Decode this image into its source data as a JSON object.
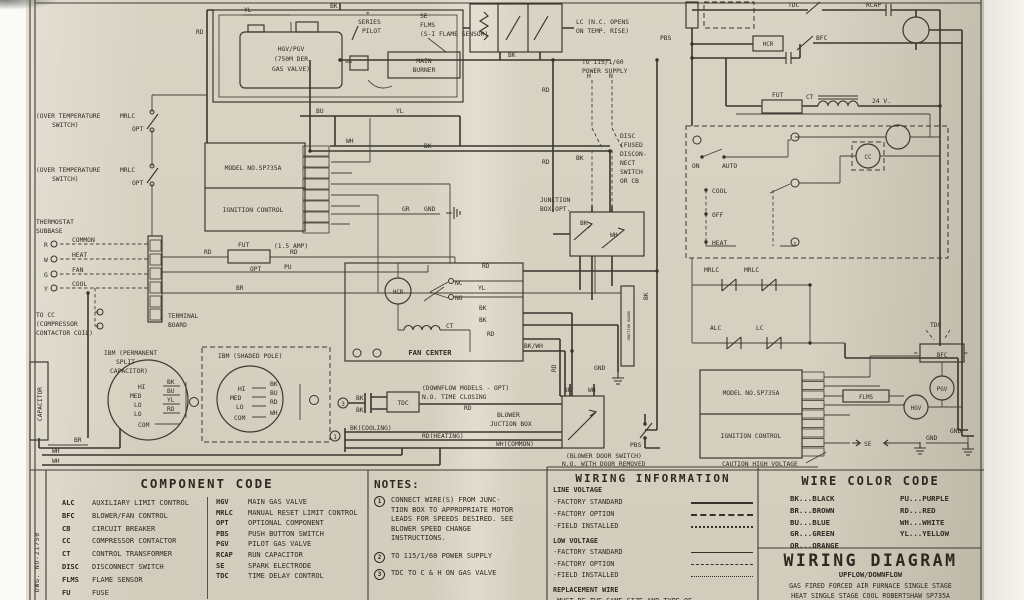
{
  "sch": {
    "top_yl": "YL",
    "top_bk": "BK",
    "left_rd": "RD",
    "valve1": "HGV/PGV",
    "valve2": "(750M DER",
    "valve3": "GAS VALVE)",
    "series1": "SERIES",
    "series2": "PILOT",
    "star": "*",
    "se1": "SE",
    "flms1": "FLMS",
    "fsensor": "(S-I FLAME SENSOR)",
    "burner1": "MAIN",
    "burner2": "BURNER",
    "bu": "BU",
    "yl2": "YL",
    "wh2": "WH",
    "bk2": "BK",
    "bk3": "BK",
    "lc1": "LC (N.C. OPENS",
    "lc2": "ON TEMP. RISE)",
    "ps1": "TO 115/1/60",
    "ps2": "POWER SUPPLY",
    "h": "H",
    "n": "N",
    "disc1": "DISC",
    "disc2": "(FUSED",
    "disc3": "DISCON-",
    "disc4": "NECT",
    "disc5": "SWITCH",
    "disc6": "OR CB",
    "bkv": "BK",
    "rd1": "RD",
    "rd2": "RD",
    "ot1": "(OVER TEMPERATURE",
    "ot2": "SWITCH)",
    "mrlc1": "MRLC",
    "opt1": "OPT",
    "ot3": "(OVER TEMPERATURE",
    "ot4": "SWITCH)",
    "mrlc2": "MRLC",
    "opt2": "OPT",
    "thermo1": "THERMOSTAT",
    "thermo2": "SUBBASE",
    "common": "COMMON",
    "heat1": "HEAT",
    "fan1": "FAN",
    "cool1": "COOL",
    "tr": "R",
    "tw": "W",
    "tg": "G",
    "ty": "Y",
    "tb1": "TERMINAL",
    "tb2": "BOARD",
    "tocc1": "TO CC",
    "tocc2": "(COMPRESSOR",
    "tocc3": "CONTACTOR COIL)",
    "cap": "CAPACITOR",
    "psc1": "IBM (PERMANENT",
    "psc2": "SPLIT",
    "psc3": "CAPACITOR)",
    "m1_hi": "HI",
    "m1_med": "MED",
    "m1_lo1": "LO",
    "m1_lo2": "LO",
    "m1_com": "COM",
    "m1_bk": "BK",
    "m1_bu": "BU",
    "m1_yl": "YL",
    "m1_rd": "RD",
    "sp1": "IBM (SHADED POLE)",
    "m2_hi": "HI",
    "m2_med": "MED",
    "m2_lo": "LO",
    "m2_com": "COM",
    "m2_bk": "BK",
    "m2_bu": "BU",
    "m2_rd": "RD",
    "m2_wh": "WH",
    "br1": "BR",
    "wh_a": "WH",
    "wh_b": "WH",
    "model1": "MODEL NO.SP735A",
    "ign1": "IGNITION CONTROL",
    "fut1": "FUT",
    "amp": "(1.5 AMP)",
    "opt3": "OPT",
    "rd3": "RD",
    "rd4": "RD",
    "pu": "PU",
    "br2": "BR",
    "gr": "GR",
    "gnd1": "GND",
    "fc": "FAN CENTER",
    "hcr1": "HCR",
    "nc": "NC",
    "no": "NO",
    "ct1": "CT",
    "rd5": "RD",
    "yl3": "YL",
    "bk4": "BK",
    "bk5": "BK",
    "rd6": "RD",
    "bkwh": "BK/WH",
    "jb1": "JUNCTION",
    "jb2": "BOX-OPT.",
    "jbk": "BK",
    "jwh": "WH",
    "jboard": "JUNCTION BOARD",
    "bk6": "BK",
    "rd7": "RD",
    "n3": "3",
    "tdc_bk1": "BK",
    "tdc_bk2": "BK",
    "tdc1": "TDC",
    "dm1": "(DOWNFLOW MODELS - OPT)",
    "dm2": "N.O. TIME CLOSING",
    "rd8": "RD",
    "bjb1": "BLOWER",
    "bjb2": "JUCTION BOX",
    "n1": "1",
    "bkc": "BK(COOLING)",
    "rdh": "RD(HEATING)",
    "whc": "WH(COMMON)",
    "bds1": "(BLOWER DOOR SWITCH)",
    "bds2": "N.O. WITH DOOR REMOVED",
    "pbs1": "PBS",
    "gnd2": "GND",
    "bk7": "BK",
    "wh3": "WH",
    "pbs2": "PBS",
    "tdc2": "TDC",
    "rcap": "RCAP",
    "hcr2": "HCR",
    "bfc1": "BFC",
    "fut2": "FUT",
    "ct2": "CT",
    "v24": "24 V.",
    "on1": "ON",
    "auto1": "AUTO",
    "cool2": "COOL",
    "off1": "OFF",
    "heat2": "HEAT",
    "cc1": "CC",
    "mrlc3": "MRLC",
    "mrlc4": "MRLC",
    "alc1": "ALC",
    "lc3": "LC",
    "tdc3": "TDC",
    "bfc2": "BFC",
    "pgv1": "PGV",
    "hgv1": "HGV",
    "flms2": "FLMS",
    "model2": "MODEL NO.SP735A",
    "ign2": "IGNITION CONTROL",
    "se2": "SE",
    "gnd3": "GND",
    "gnd4": "GND",
    "caution": "CAUTION HIGH VOLTAGE"
  },
  "code": {
    "title": "COMPONENT CODE",
    "col1": [
      {
        "abbr": "ALC",
        "desc": "AUXILIARY LIMIT CONTROL"
      },
      {
        "abbr": "BFC",
        "desc": "BLOWER/FAN CONTROL"
      },
      {
        "abbr": "CB",
        "desc": "CIRCUIT BREAKER"
      },
      {
        "abbr": "CC",
        "desc": "COMPRESSOR CONTACTOR"
      },
      {
        "abbr": "CT",
        "desc": "CONTROL TRANSFORMER"
      },
      {
        "abbr": "DISC",
        "desc": "DISCONNECT SWITCH"
      },
      {
        "abbr": "FLMS",
        "desc": "FLAME SENSOR"
      },
      {
        "abbr": "FU",
        "desc": "FUSE"
      }
    ],
    "col2": [
      {
        "abbr": "HGV",
        "desc": "MAIN GAS VALVE"
      },
      {
        "abbr": "MRLC",
        "desc": "MANUAL RESET LIMIT CONTROL"
      },
      {
        "abbr": "OPT",
        "desc": "OPTIONAL COMPONENT"
      },
      {
        "abbr": "PBS",
        "desc": "PUSH BUTTON SWITCH"
      },
      {
        "abbr": "PGV",
        "desc": "PILOT GAS VALVE"
      },
      {
        "abbr": "RCAP",
        "desc": "RUN CAPACITOR"
      },
      {
        "abbr": "SE",
        "desc": "SPARK ELECTRODE"
      },
      {
        "abbr": "TDC",
        "desc": "TIME DELAY CONTROL"
      }
    ]
  },
  "notes": {
    "title": "NOTES:",
    "items": [
      {
        "num": "1",
        "text": "CONNECT WIRE(S) FROM JUNC- TION BOX TO APPROPRIATE MOTOR LEADS FOR SPEEDS DESIRED. SEE BLOWER SPEED CHANGE INSTRUCTIONS."
      },
      {
        "num": "2",
        "text": "TO 115/1/60 POWER SUPPLY"
      },
      {
        "num": "3",
        "text": "TDC TO C & H ON GAS VALVE"
      }
    ]
  },
  "winfo": {
    "title": "WIRING INFORMATION",
    "line_voltage": "LINE VOLTAGE",
    "low_voltage": "LOW VOLTAGE",
    "rows_line": [
      "-FACTORY STANDARD",
      "-FACTORY OPTION",
      "-FIELD INSTALLED"
    ],
    "rows_low": [
      "-FACTORY STANDARD",
      "-FACTORY OPTION",
      "-FIELD INSTALLED"
    ],
    "replacement": "REPLACEMENT WIRE",
    "replacement_text": "-MUST BE THE SAME SIZE AND TYPE OF"
  },
  "wcolor": {
    "title": "WIRE COLOR CODE",
    "col1": [
      "BK...BLACK",
      "BR...BROWN",
      "BU...BLUE",
      "GR...GREEN",
      "OR...ORANGE"
    ],
    "col2": [
      "PU...PURPLE",
      "RD...RED",
      "WH...WHITE",
      "YL...YELLOW"
    ]
  },
  "titleblock": {
    "title": "WIRING DIAGRAM",
    "subtitle": "UPFLOW/DOWNFLOW",
    "line1": "GAS FIRED FORCED AIR FURNACE SINGLE STAGE",
    "line2": "HEAT SINGLE STAGE COOL ROBERTSHAW SP735A"
  },
  "sidenote": "DWG. NO-21750"
}
